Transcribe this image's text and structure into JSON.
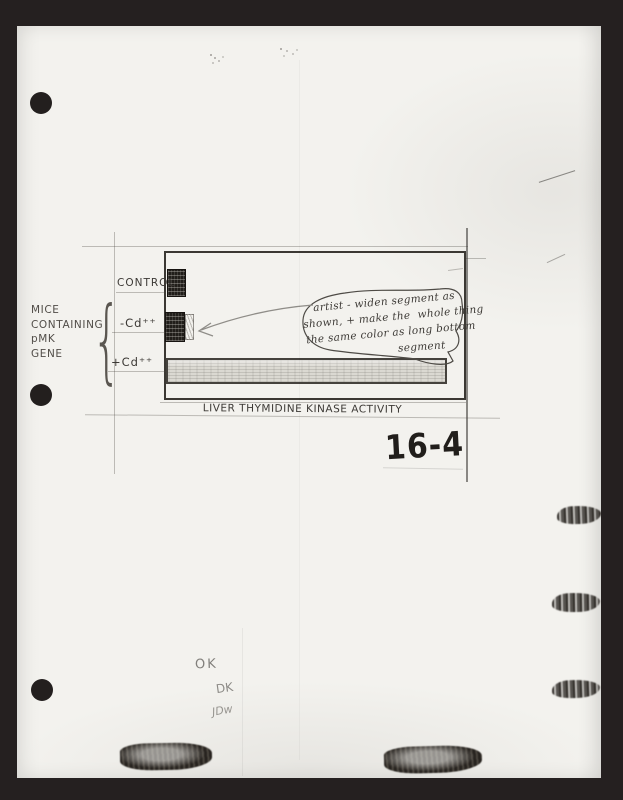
{
  "document": {
    "figure_number": "16-4",
    "approval_marks": {
      "ok": "OK",
      "dk": "DK",
      "initials": "JDw"
    }
  },
  "figure": {
    "axis_title": "LIVER THYMIDINE KINASE ACTIVITY",
    "row_labels": {
      "control": "CONTROL",
      "minus_cd": "-Cd⁺⁺",
      "plus_cd": "+Cd⁺⁺"
    },
    "group_label": {
      "line1": "MICE",
      "line2": "CONTAINING",
      "line3": "pMK",
      "line4": "GENE"
    },
    "brace_glyph": "{"
  },
  "artist_note": {
    "line1": "artist - widen segment as",
    "line2": "shown, + make the  whole thing",
    "line3": "the same color as long bottom",
    "line4": "segment"
  },
  "chart_data": {
    "type": "bar",
    "orientation": "horizontal",
    "title": "",
    "xlabel": "LIVER THYMIDINE KINASE ACTIVITY",
    "categories": [
      "CONTROL",
      "-Cd⁺⁺",
      "+Cd⁺⁺"
    ],
    "values": [
      0.06,
      0.065,
      1.0
    ],
    "values_note": "relative bar lengths; hand-drawn figure with no numeric axis",
    "group_label": "MICE CONTAINING pMK GENE (brace spans -Cd⁺⁺ and +Cd⁺⁺ rows)",
    "annotation": "artist - widen segment as shown, + make the whole thing the same color as long bottom segment"
  },
  "colors": {
    "background": "#252020",
    "paper": "#f3f2ee",
    "ink": "#35322e",
    "pencil": "#8b8985",
    "bar_dark": "#211e1a",
    "bar_light": "#dbd9d2"
  }
}
